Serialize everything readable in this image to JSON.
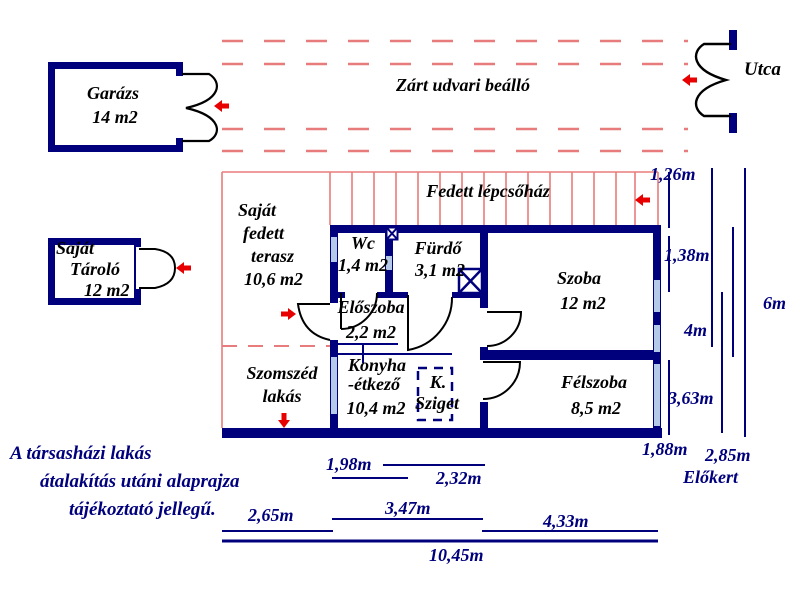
{
  "colors": {
    "wall_navy": "#00007d",
    "window_blue": "#b5c9e8",
    "hatch_red": "#e87c7c",
    "arrow_red": "#e80000",
    "door_black": "#000000"
  },
  "garage": {
    "name": "Garázs",
    "area": "14 m2"
  },
  "street": {
    "label": "Utca"
  },
  "courtyard": {
    "label": "Zárt udvari beálló"
  },
  "storage": {
    "l1": "Saját",
    "l2": "Tároló",
    "l3": "12 m2"
  },
  "stairwell": {
    "label": "Fedett lépcsőház"
  },
  "terrace": {
    "l1": "Saját",
    "l2": "fedett",
    "l3": "terasz",
    "l4": "10,6 m2"
  },
  "rooms": {
    "wc": {
      "name": "Wc",
      "area": "1,4 m2"
    },
    "bath": {
      "name": "Fürdő",
      "area": "3,1 m2"
    },
    "room": {
      "name": "Szoba",
      "area": "12 m2"
    },
    "hall": {
      "name": "Előszoba",
      "area": "2,2 m2"
    },
    "kitchen": {
      "l1": "Konyha",
      "l2": "-étkező",
      "area": "10,4 m2"
    },
    "island": {
      "l1": "K.",
      "l2": "Sziget"
    },
    "halfroom": {
      "name": "Félszoba",
      "area": "8,5 m2"
    },
    "neighbor": {
      "l1": "Szomszéd",
      "l2": "lakás"
    }
  },
  "dims": {
    "d126": "1,26m",
    "d138": "1,38m",
    "d4": "4m",
    "d6": "6m",
    "d363": "3,63m",
    "d188": "1,88m",
    "d285": "2,85m",
    "frontgarden": "Előkert",
    "d198": "1,98m",
    "d232": "2,32m",
    "d265": "2,65m",
    "d347": "3,47m",
    "d433": "4,33m",
    "d1045": "10,45m"
  },
  "note": {
    "l1": "A társasházi lakás",
    "l2": "átalakítás utáni alaprajza",
    "l3": "tájékoztató jellegű."
  }
}
